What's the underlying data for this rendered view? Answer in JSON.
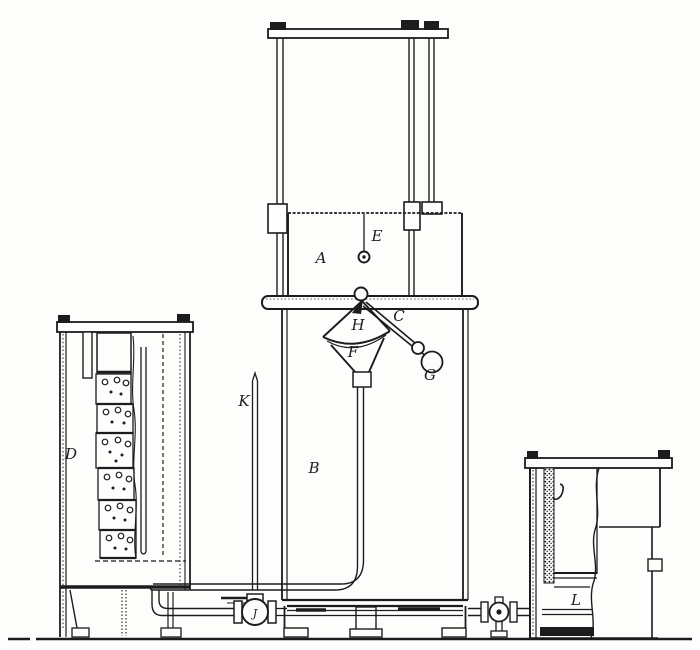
{
  "figure": {
    "title": "",
    "ink_color": "#1c1c1c",
    "paper_color": "#fdfdfc"
  },
  "labels": {
    "A": "A",
    "B": "B",
    "C": "C",
    "D": "D",
    "E": "E",
    "F": "F",
    "G": "G",
    "H": "H",
    "J": "J",
    "K": "K",
    "L": "L"
  }
}
